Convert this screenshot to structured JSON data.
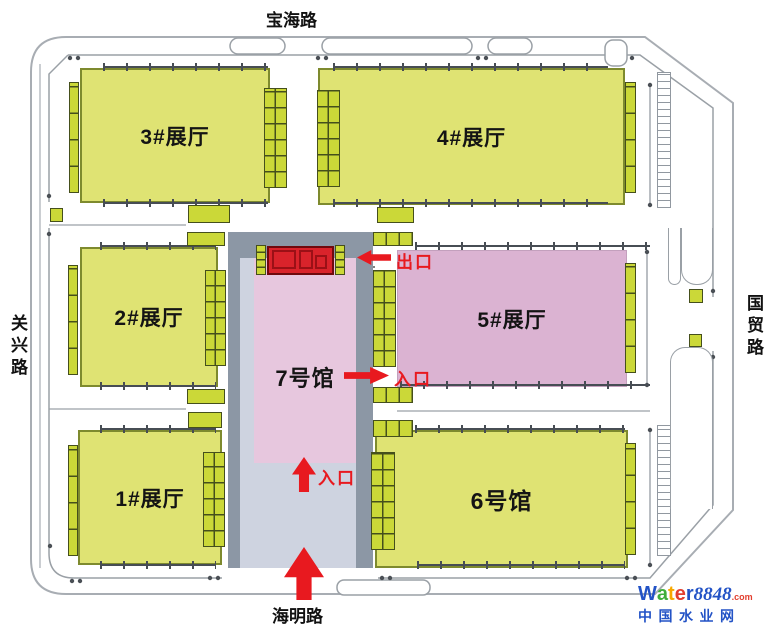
{
  "roads": {
    "top": "宝海路",
    "left": "关兴路",
    "right": "国贸路",
    "bottom": "海明路"
  },
  "halls": [
    {
      "id": "3",
      "label": "3#展厅",
      "color": "#dfe373"
    },
    {
      "id": "4",
      "label": "4#展厅",
      "color": "#dfe373"
    },
    {
      "id": "2",
      "label": "2#展厅",
      "color": "#dfe373"
    },
    {
      "id": "5",
      "label": "5#展厅",
      "color": "#dbb3d2"
    },
    {
      "id": "1",
      "label": "1#展厅",
      "color": "#dfe373"
    },
    {
      "id": "6",
      "label": "6号馆",
      "color": "#dfe373"
    },
    {
      "id": "7",
      "label": "7号馆",
      "color": "#e7c7de"
    }
  ],
  "markers": {
    "exit_label": "出口",
    "entrance_label": "入口"
  },
  "colors": {
    "hall_yellow": "#dfe373",
    "hall_pink": "#dbb3d2",
    "hall7_pink": "#e7c7de",
    "dock_yellow": "#cbd838",
    "dock_border": "#454f1c",
    "accent_red": "#e8191f",
    "column_gray": "#8c97a5",
    "walkway_lavender": "#ced3e0",
    "boundary_gray": "#9aa0a6"
  },
  "watermark": {
    "brand_letters": [
      {
        "ch": "W",
        "color": "#2353c6"
      },
      {
        "ch": "a",
        "color": "#3fae3b"
      },
      {
        "ch": "t",
        "color": "#f7a800"
      },
      {
        "ch": "e",
        "color": "#e23e2e"
      },
      {
        "ch": "r",
        "color": "#2353c6"
      }
    ],
    "brand_number": "8848",
    "brand_tld": ".com",
    "site_name": "中国水业网"
  }
}
